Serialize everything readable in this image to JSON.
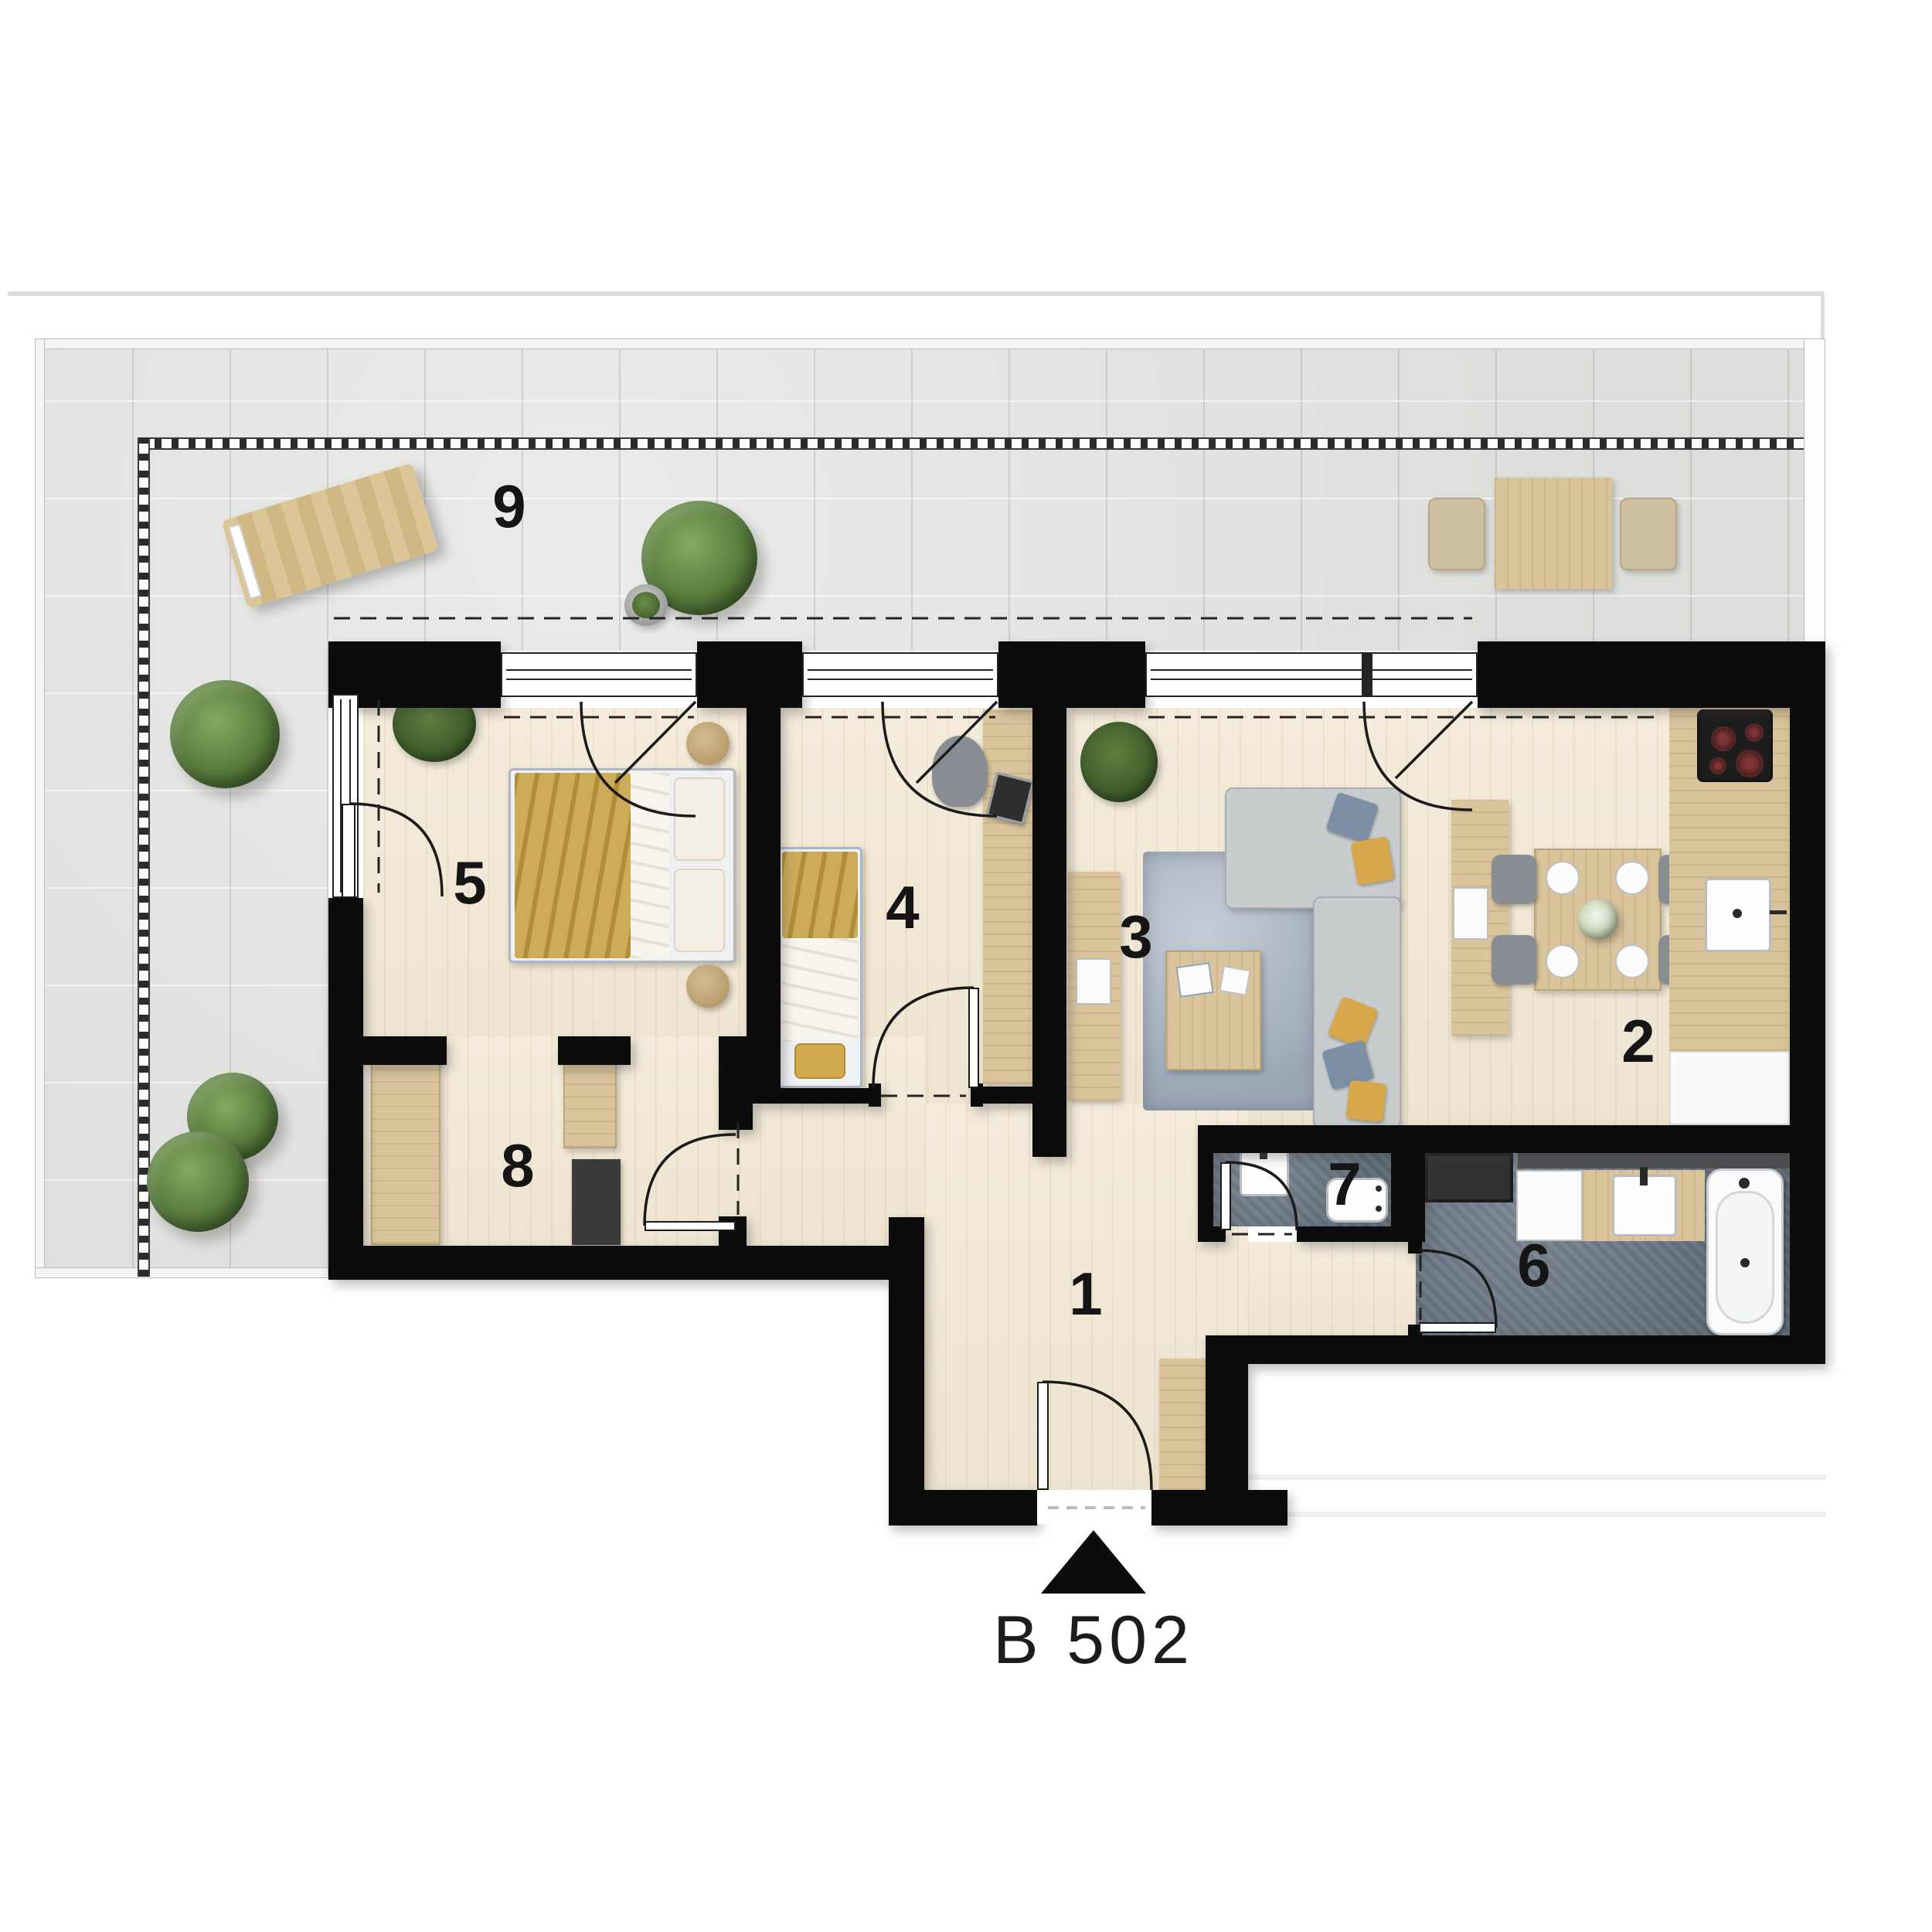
{
  "apartment": {
    "id": "B 502"
  },
  "rooms": [
    {
      "number": "1"
    },
    {
      "number": "2"
    },
    {
      "number": "3"
    },
    {
      "number": "4"
    },
    {
      "number": "5"
    },
    {
      "number": "6"
    },
    {
      "number": "7"
    },
    {
      "number": "8"
    },
    {
      "number": "9"
    }
  ],
  "colors": {
    "wall": "#0c0c0c",
    "wood_floor": "#f2e8d4",
    "terrace_tile": "#e4e5e2",
    "wet_room_floor": "#6d7987",
    "furniture_wood": "#d9c49c",
    "textile_mustard": "#c59f42",
    "textile_blue": "#7d8fa5",
    "rug": "#b2bcca",
    "label_text": "#151515"
  }
}
